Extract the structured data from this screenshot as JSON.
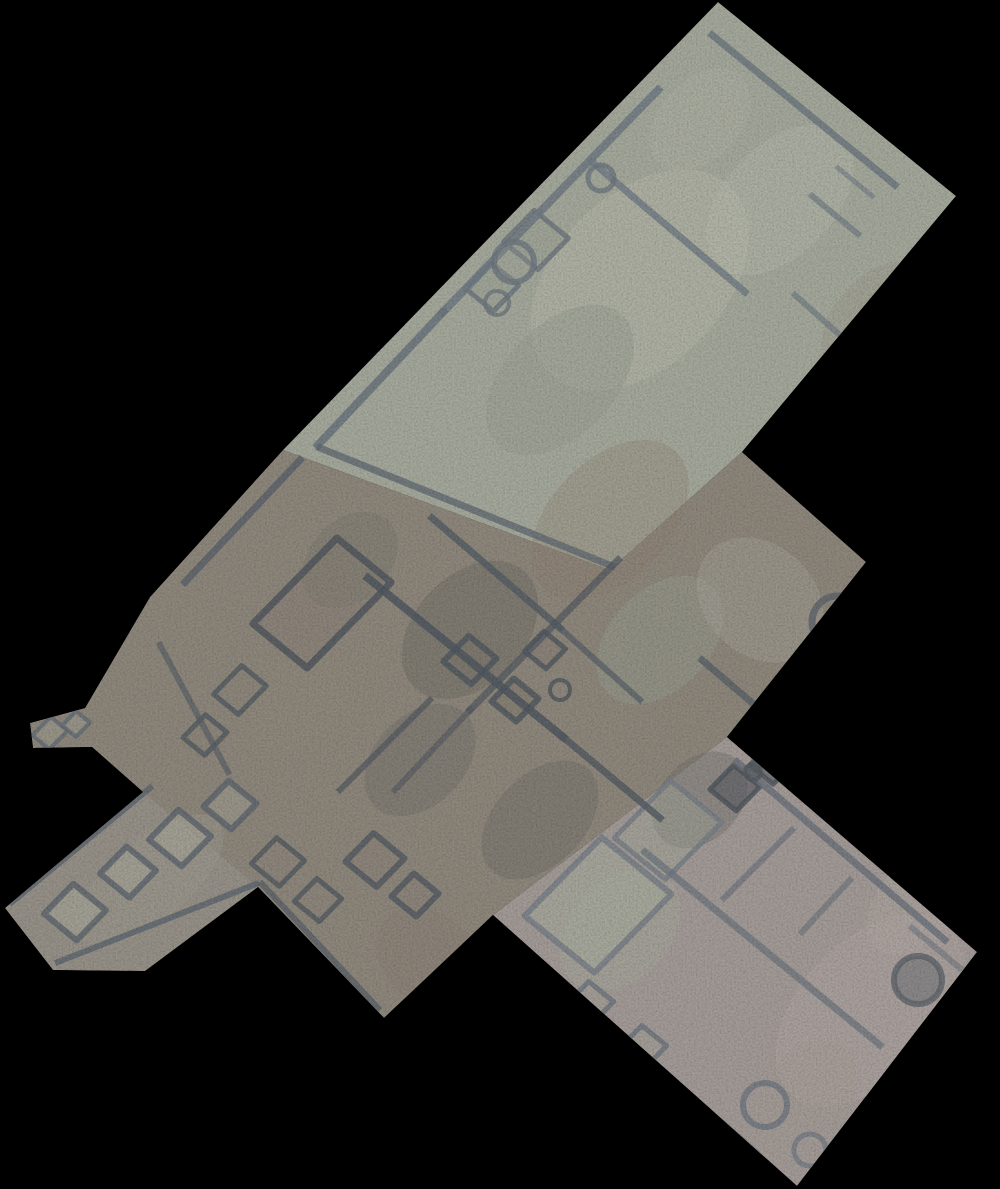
{
  "scene": {
    "type": "aerial-orthophoto-mosaic",
    "subject": "top-down orthomosaic of an excavated archaeological site (stone wall foundations, rooms, circular pits) on a black background",
    "background": "#000000",
    "canvas": {
      "width": 1000,
      "height": 1189
    }
  },
  "palette": {
    "background": "#000000",
    "ground_north": "#a4a89b",
    "ground_center": "#8d867b",
    "ground_south": "#a29a96",
    "ground_arm": "#96918a",
    "wall_dark": "#4f575f",
    "wall_light": "#6e7780",
    "patch_light": "#b3b5a8",
    "patch_dark": "#6f6d65"
  },
  "site": {
    "outline": "718,2 956,196 742,452 866,562 727,737 977,952 797,1186 493,915 384,1018 258,887 145,971 53,970 5,908 143,792 92,747 33,748 30,723 85,708 150,597 283,450",
    "regions": [
      {
        "name": "north-trench",
        "points": "718,2 956,196 742,452 610,570 283,450",
        "fill": "#a4a89b",
        "opacity": 1
      },
      {
        "name": "central-area",
        "points": "283,450 610,570 742,452 866,562 727,737 493,915 384,1018 258,887 145,971 53,970 5,908 143,792 92,747 33,748 30,723 85,708 150,597",
        "fill": "#8d867b",
        "opacity": 1
      },
      {
        "name": "south-trench",
        "points": "727,737 977,952 797,1186 493,915",
        "fill": "#a29a96",
        "opacity": 1
      },
      {
        "name": "west-arm",
        "points": "5,908 143,792 258,887 145,971 53,970",
        "fill": "#97928a",
        "opacity": 0.85
      }
    ]
  },
  "patches": [
    {
      "cx": 640,
      "cy": 280,
      "rx": 130,
      "ry": 85,
      "rot": -46,
      "fill": "#b3b5a8",
      "op": 0.5
    },
    {
      "cx": 780,
      "cy": 200,
      "rx": 90,
      "ry": 55,
      "rot": -46,
      "fill": "#b6b8ac",
      "op": 0.4
    },
    {
      "cx": 700,
      "cy": 120,
      "rx": 60,
      "ry": 40,
      "rot": -46,
      "fill": "#aeb0a3",
      "op": 0.4
    },
    {
      "cx": 560,
      "cy": 380,
      "rx": 90,
      "ry": 55,
      "rot": -46,
      "fill": "#979c90",
      "op": 0.45
    },
    {
      "cx": 880,
      "cy": 320,
      "rx": 70,
      "ry": 45,
      "rot": -46,
      "fill": "#9b9488",
      "op": 0.35
    },
    {
      "cx": 470,
      "cy": 630,
      "rx": 80,
      "ry": 55,
      "rot": -46,
      "fill": "#6f6d65",
      "op": 0.5
    },
    {
      "cx": 420,
      "cy": 760,
      "rx": 65,
      "ry": 45,
      "rot": -46,
      "fill": "#74726a",
      "op": 0.45
    },
    {
      "cx": 610,
      "cy": 520,
      "rx": 95,
      "ry": 60,
      "rot": -46,
      "fill": "#8f7e6d",
      "op": 0.3
    },
    {
      "cx": 350,
      "cy": 560,
      "rx": 55,
      "ry": 40,
      "rot": -46,
      "fill": "#7a776e",
      "op": 0.4
    },
    {
      "cx": 660,
      "cy": 640,
      "rx": 75,
      "ry": 50,
      "rot": -46,
      "fill": "#99a093",
      "op": 0.4
    },
    {
      "cx": 540,
      "cy": 820,
      "rx": 70,
      "ry": 45,
      "rot": -46,
      "fill": "#6e6c66",
      "op": 0.4
    },
    {
      "cx": 430,
      "cy": 960,
      "rx": 45,
      "ry": 60,
      "rot": -46,
      "fill": "#8a8076",
      "op": 0.45
    },
    {
      "cx": 300,
      "cy": 700,
      "rx": 60,
      "ry": 40,
      "rot": -46,
      "fill": "#8f887c",
      "op": 0.5
    },
    {
      "cx": 760,
      "cy": 600,
      "rx": 55,
      "ry": 70,
      "rot": -46,
      "fill": "#a8a59a",
      "op": 0.4
    },
    {
      "cx": 870,
      "cy": 1010,
      "rx": 115,
      "ry": 70,
      "rot": -46,
      "fill": "#b0a6a3",
      "op": 0.45
    },
    {
      "cx": 920,
      "cy": 900,
      "rx": 65,
      "ry": 40,
      "rot": -46,
      "fill": "#b2a8a4",
      "op": 0.35
    },
    {
      "cx": 700,
      "cy": 800,
      "rx": 55,
      "ry": 40,
      "rot": -46,
      "fill": "#6f6f69",
      "op": 0.4
    },
    {
      "cx": 620,
      "cy": 930,
      "rx": 70,
      "ry": 50,
      "rot": -46,
      "fill": "#a4ab9a",
      "op": 0.4
    },
    {
      "cx": 800,
      "cy": 1100,
      "rx": 70,
      "ry": 45,
      "rot": -46,
      "fill": "#a39a94",
      "op": 0.4
    },
    {
      "cx": 150,
      "cy": 880,
      "rx": 90,
      "ry": 40,
      "rot": -40,
      "fill": "#9c978e",
      "op": 0.5
    }
  ],
  "walls": [
    {
      "x1": 712,
      "y1": 35,
      "x2": 895,
      "y2": 185,
      "w": 7,
      "c": "#6c757e",
      "o": 0.8
    },
    {
      "x1": 658,
      "y1": 90,
      "x2": 443,
      "y2": 312,
      "w": 8,
      "c": "#707a83",
      "o": 0.85
    },
    {
      "x1": 443,
      "y1": 312,
      "x2": 318,
      "y2": 445,
      "w": 8,
      "c": "#6b747d",
      "o": 0.85
    },
    {
      "x1": 592,
      "y1": 162,
      "x2": 745,
      "y2": 292,
      "w": 7,
      "c": "#717b84",
      "o": 0.8
    },
    {
      "x1": 812,
      "y1": 196,
      "x2": 858,
      "y2": 234,
      "w": 6,
      "c": "#727c85",
      "o": 0.7
    },
    {
      "x1": 838,
      "y1": 168,
      "x2": 872,
      "y2": 196,
      "w": 5,
      "c": "#727c85",
      "o": 0.6
    },
    {
      "x1": 795,
      "y1": 295,
      "x2": 843,
      "y2": 338,
      "w": 6,
      "c": "#6f7982",
      "o": 0.65
    },
    {
      "x1": 300,
      "y1": 460,
      "x2": 185,
      "y2": 582,
      "w": 7,
      "c": "#5a626b",
      "o": 0.8
    },
    {
      "x1": 320,
      "y1": 448,
      "x2": 612,
      "y2": 566,
      "w": 7,
      "c": "#5f6770",
      "o": 0.75
    },
    {
      "x1": 368,
      "y1": 578,
      "x2": 563,
      "y2": 737,
      "w": 8,
      "c": "#4f575f",
      "o": 0.85
    },
    {
      "x1": 563,
      "y1": 737,
      "x2": 660,
      "y2": 818,
      "w": 7,
      "c": "#525a62",
      "o": 0.8
    },
    {
      "x1": 432,
      "y1": 518,
      "x2": 560,
      "y2": 628,
      "w": 7,
      "c": "#545c64",
      "o": 0.8
    },
    {
      "x1": 618,
      "y1": 560,
      "x2": 470,
      "y2": 710,
      "w": 7,
      "c": "#515961",
      "o": 0.7
    },
    {
      "x1": 470,
      "y1": 710,
      "x2": 395,
      "y2": 790,
      "w": 6,
      "c": "#515961",
      "o": 0.6
    },
    {
      "x1": 262,
      "y1": 884,
      "x2": 378,
      "y2": 1008,
      "w": 6,
      "c": "#565e66",
      "o": 0.7
    },
    {
      "x1": 702,
      "y1": 660,
      "x2": 798,
      "y2": 742,
      "w": 7,
      "c": "#575f67",
      "o": 0.75
    },
    {
      "x1": 560,
      "y1": 628,
      "x2": 640,
      "y2": 700,
      "w": 6,
      "c": "#565e66",
      "o": 0.7
    },
    {
      "x1": 340,
      "y1": 790,
      "x2": 430,
      "y2": 700,
      "w": 6,
      "c": "#515961",
      "o": 0.7
    },
    {
      "x1": 160,
      "y1": 645,
      "x2": 228,
      "y2": 772,
      "w": 6,
      "c": "#565e66",
      "o": 0.65
    },
    {
      "x1": 12,
      "y1": 902,
      "x2": 150,
      "y2": 788,
      "w": 6,
      "c": "#5d656e",
      "o": 0.8
    },
    {
      "x1": 58,
      "y1": 962,
      "x2": 256,
      "y2": 884,
      "w": 6,
      "c": "#5d656e",
      "o": 0.8
    },
    {
      "x1": 737,
      "y1": 762,
      "x2": 945,
      "y2": 940,
      "w": 7,
      "c": "#6b727b",
      "o": 0.8
    },
    {
      "x1": 645,
      "y1": 852,
      "x2": 880,
      "y2": 1045,
      "w": 7,
      "c": "#6e757e",
      "o": 0.75
    },
    {
      "x1": 516,
      "y1": 946,
      "x2": 756,
      "y2": 1152,
      "w": 6,
      "c": "#757c85",
      "o": 0.6
    },
    {
      "x1": 792,
      "y1": 830,
      "x2": 724,
      "y2": 898,
      "w": 6,
      "c": "#6d747d",
      "o": 0.7
    },
    {
      "x1": 850,
      "y1": 880,
      "x2": 802,
      "y2": 932,
      "w": 6,
      "c": "#6d747d",
      "o": 0.65
    },
    {
      "x1": 912,
      "y1": 928,
      "x2": 960,
      "y2": 968,
      "w": 6,
      "c": "#707780",
      "o": 0.6
    }
  ],
  "rooms": [
    {
      "cx": 536,
      "cy": 240,
      "a": 22,
      "b": 22,
      "fill": "#9aa094",
      "fo": 0.5,
      "stroke": "#6b747d",
      "sw": 5
    },
    {
      "cx": 492,
      "cy": 287,
      "a": 18,
      "b": 18,
      "fill": "#9aa094",
      "fo": 0.5,
      "stroke": "#6b747d",
      "sw": 5
    },
    {
      "cx": 322,
      "cy": 603,
      "a": 60,
      "b": 35,
      "fill": "#877f73",
      "fo": 0.3,
      "stroke": "#4d555d",
      "sw": 7
    },
    {
      "cx": 470,
      "cy": 660,
      "a": 18,
      "b": 18,
      "fill": "#7c756b",
      "fo": 0.4,
      "stroke": "#4f575f",
      "sw": 6
    },
    {
      "cx": 515,
      "cy": 700,
      "a": 16,
      "b": 16,
      "fill": "#7c756b",
      "fo": 0.4,
      "stroke": "#4f575f",
      "sw": 6
    },
    {
      "cx": 545,
      "cy": 650,
      "a": 14,
      "b": 14,
      "fill": "#847c71",
      "fo": 0.3,
      "stroke": "#4f575f",
      "sw": 5
    },
    {
      "cx": 375,
      "cy": 860,
      "a": 20,
      "b": 20,
      "fill": "#8a8278",
      "fo": 0.3,
      "stroke": "#525a62",
      "sw": 6
    },
    {
      "cx": 415,
      "cy": 895,
      "a": 16,
      "b": 16,
      "fill": "#8a8278",
      "fo": 0.3,
      "stroke": "#525a62",
      "sw": 6
    },
    {
      "cx": 278,
      "cy": 862,
      "a": 18,
      "b": 18,
      "fill": "#8d857a",
      "fo": 0.3,
      "stroke": "#525a62",
      "sw": 5
    },
    {
      "cx": 318,
      "cy": 900,
      "a": 16,
      "b": 16,
      "fill": "#8d857a",
      "fo": 0.3,
      "stroke": "#525a62",
      "sw": 5
    },
    {
      "cx": 240,
      "cy": 690,
      "a": 20,
      "b": 16,
      "fill": "#8b8377",
      "fo": 0.35,
      "stroke": "#535b63",
      "sw": 5
    },
    {
      "cx": 205,
      "cy": 735,
      "a": 16,
      "b": 14,
      "fill": "#8b8377",
      "fo": 0.35,
      "stroke": "#535b63",
      "sw": 5
    },
    {
      "cx": 75,
      "cy": 912,
      "a": 21,
      "b": 21,
      "fill": "#aaa89b",
      "fo": 0.55,
      "stroke": "#5c646d",
      "sw": 6
    },
    {
      "cx": 128,
      "cy": 872,
      "a": 19,
      "b": 19,
      "fill": "#a8a699",
      "fo": 0.55,
      "stroke": "#5c646d",
      "sw": 6
    },
    {
      "cx": 180,
      "cy": 838,
      "a": 21,
      "b": 21,
      "fill": "#aaa89b",
      "fo": 0.5,
      "stroke": "#5c646d",
      "sw": 6
    },
    {
      "cx": 230,
      "cy": 805,
      "a": 18,
      "b": 18,
      "fill": "#a5a396",
      "fo": 0.45,
      "stroke": "#5c646d",
      "sw": 6
    },
    {
      "cx": 50,
      "cy": 733,
      "a": 13,
      "b": 11,
      "fill": "#a09d91",
      "fo": 0.5,
      "stroke": "#636b74",
      "sw": 4
    },
    {
      "cx": 76,
      "cy": 724,
      "a": 10,
      "b": 9,
      "fill": "#a09d91",
      "fo": 0.5,
      "stroke": "#636b74",
      "sw": 4
    },
    {
      "cx": 598,
      "cy": 905,
      "a": 55,
      "b": 45,
      "fill": "#a7ad9e",
      "fo": 0.55,
      "stroke": "#767d86",
      "sw": 6
    },
    {
      "cx": 668,
      "cy": 830,
      "a": 40,
      "b": 33,
      "fill": "#9fa697",
      "fo": 0.45,
      "stroke": "#767d86",
      "sw": 5
    },
    {
      "cx": 735,
      "cy": 788,
      "a": 17,
      "b": 17,
      "fill": "#585c60",
      "fo": 0.6,
      "stroke": "#4e555d",
      "sw": 5
    },
    {
      "cx": 772,
      "cy": 764,
      "a": 15,
      "b": 15,
      "fill": "#585c60",
      "fo": 0.55,
      "stroke": "#4e555d",
      "sw": 5
    },
    {
      "cx": 590,
      "cy": 1003,
      "a": 16,
      "b": 16,
      "fill": "#a39f94",
      "fo": 0.4,
      "stroke": "#6d747d",
      "sw": 5
    },
    {
      "cx": 643,
      "cy": 1047,
      "a": 16,
      "b": 16,
      "fill": "#a39f94",
      "fo": 0.4,
      "stroke": "#6d747d",
      "sw": 5
    }
  ],
  "circles": [
    {
      "cx": 601,
      "cy": 178,
      "r": 13,
      "stroke": "#6e7780",
      "sw": 5,
      "fill": "none",
      "fo": 0
    },
    {
      "cx": 514,
      "cy": 262,
      "r": 20,
      "stroke": "#6e7780",
      "sw": 6,
      "fill": "#9aa094",
      "fo": 0.3
    },
    {
      "cx": 497,
      "cy": 303,
      "r": 12,
      "stroke": "#6e7780",
      "sw": 4,
      "fill": "none",
      "fo": 0
    },
    {
      "cx": 838,
      "cy": 622,
      "r": 26,
      "stroke": "#5e646b",
      "sw": 7,
      "fill": "none",
      "fo": 0
    },
    {
      "cx": 918,
      "cy": 980,
      "r": 24,
      "stroke": "#5f646a",
      "sw": 6,
      "fill": "#6a6e72",
      "fo": 0.5
    },
    {
      "cx": 765,
      "cy": 1105,
      "r": 22,
      "stroke": "#6f767f",
      "sw": 6,
      "fill": "none",
      "fo": 0
    },
    {
      "cx": 810,
      "cy": 1150,
      "r": 16,
      "stroke": "#757c85",
      "sw": 5,
      "fill": "none",
      "fo": 0
    },
    {
      "cx": 753,
      "cy": 772,
      "r": 8,
      "stroke": "#555a60",
      "sw": 4,
      "fill": "#555a60",
      "fo": 0.6
    },
    {
      "cx": 560,
      "cy": 690,
      "r": 10,
      "stroke": "#4f575f",
      "sw": 4,
      "fill": "none",
      "fo": 0
    }
  ]
}
